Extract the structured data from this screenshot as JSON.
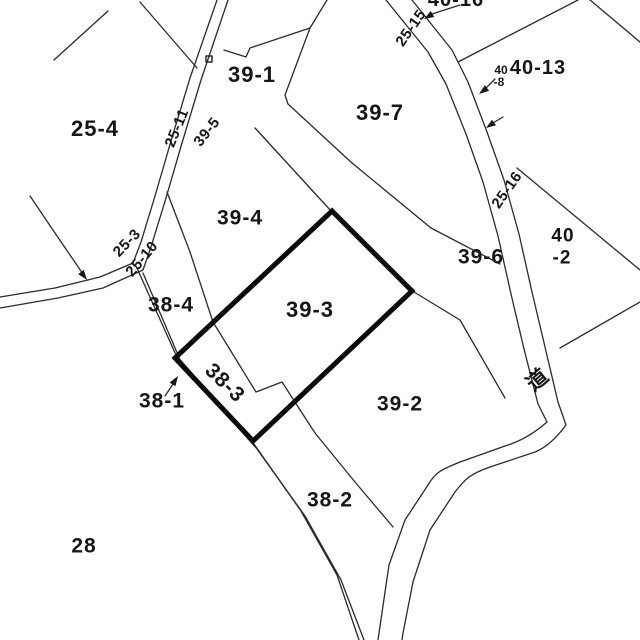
{
  "labels": {
    "p25_4": "25-4",
    "p39_1": "39-1",
    "p39_7": "39-7",
    "p40_13": "40-13",
    "p40_8_line1": "40",
    "p40_8_line2": "-8",
    "p40_16_partial": "40-16",
    "p25_11": "25-11",
    "p39_5": "39-5",
    "p25_15": "25-15",
    "p25_16": "25-16",
    "p25_3": "25-3",
    "p25_10": "25-10",
    "p39_4": "39-4",
    "p38_4": "38-4",
    "p39_3": "39-3",
    "p38_3": "38-3",
    "p39_6": "39-6",
    "p40_2_line1": "40",
    "p40_2_line2": "-2",
    "p38_1": "38-1",
    "p39_2": "39-2",
    "p38_2": "38-2",
    "p28": "28",
    "road_kanji": "道"
  },
  "colors": {
    "background": "#ffffff",
    "thin_line": "#2b2b2b",
    "bold_outline": "#0a0a0a",
    "text": "#161616"
  },
  "selected_parcel": "39-3"
}
